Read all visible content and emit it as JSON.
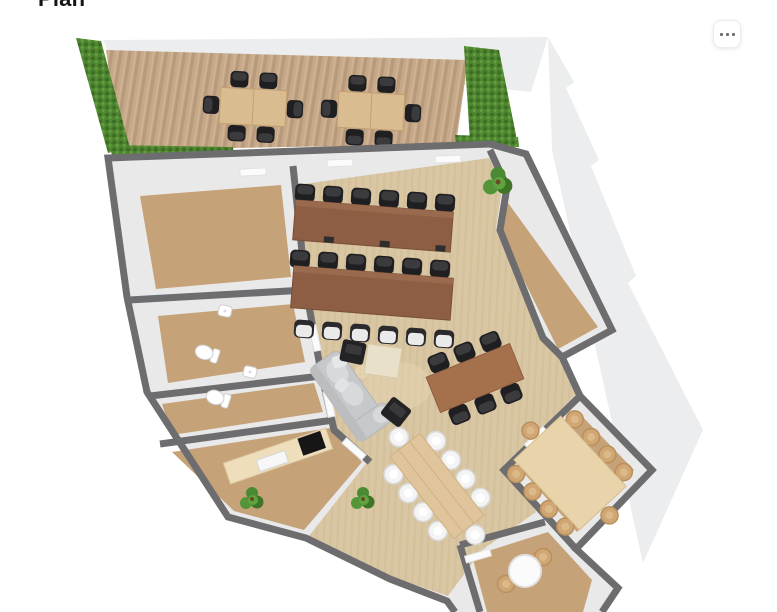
{
  "page": {
    "title": "Plan"
  },
  "header": {
    "more_button": {
      "icon": "ellipsis-icon",
      "aria_label": "More options"
    }
  },
  "floorplan": {
    "description": "3D top-down render of an office floor plan",
    "view": "top-down 3D",
    "colors": {
      "background": "#ffffff",
      "ghost": "#ecedee",
      "wall": "#6d6d6f",
      "floor_margin": "#e9e9e9",
      "carpet": "#c6a279",
      "wood_floor": "#d9c7a4",
      "deck_wood": "#c6a988",
      "hedge": "#4e8430",
      "desk_wood": "#8d5e43",
      "meeting_table": "#a5714d",
      "conference_table": "#e9d3ab",
      "dining_table": "#e0c49c",
      "chair_dark": "#1f1f21",
      "chair_light_seat": "#eaeaea",
      "chair_tan": "#cfa674",
      "sofa": "#c7c8c9",
      "pouf": "#232325",
      "coffee_table": "#e9e0c9",
      "counter": "#eedebb",
      "plant": "#4a8a32",
      "fixture_white": "#ffffff"
    },
    "areas": [
      {
        "name": "terrace",
        "floor": "wood decking",
        "features": "hedges on both sides, 2 outdoor tables with 6 dark chairs each"
      },
      {
        "name": "open-office",
        "floor": "light wood",
        "features": "2 long desk rows (6 dark chairs behind each, 6 light chairs in front of second), lounge sofa with 2 poufs and coffee table, round rug"
      },
      {
        "name": "meeting-area",
        "features": "brown table with 6 dark chairs"
      },
      {
        "name": "dining-area",
        "features": "long wood table with 10 white chairs"
      },
      {
        "name": "private-room-top-left",
        "floor": "carpet"
      },
      {
        "name": "restroom-1",
        "features": "toilet, wall sink"
      },
      {
        "name": "restroom-2",
        "features": "toilet, wall sink"
      },
      {
        "name": "kitchenette",
        "features": "counter with cooktop and sink"
      },
      {
        "name": "side-room-right",
        "floor": "carpet"
      },
      {
        "name": "conference-room",
        "features": "large light-wood table with 10 tan chairs"
      },
      {
        "name": "breakout-room-bottom",
        "features": "round white table, 2 tan chairs"
      }
    ],
    "furniture_counts": {
      "outdoor_tables": 2,
      "outdoor_chairs": 12,
      "desk_rows": 2,
      "desk_chairs_dark": 12,
      "desk_chairs_light": 6,
      "meeting_chairs": 6,
      "dining_chairs_white": 10,
      "conference_chairs": 10,
      "breakout_chairs": 2,
      "sofas": 1,
      "poufs": 2,
      "coffee_tables": 1,
      "plants_indoor": 3,
      "toilets": 2,
      "sinks": 2,
      "doors_visible": 7
    }
  }
}
